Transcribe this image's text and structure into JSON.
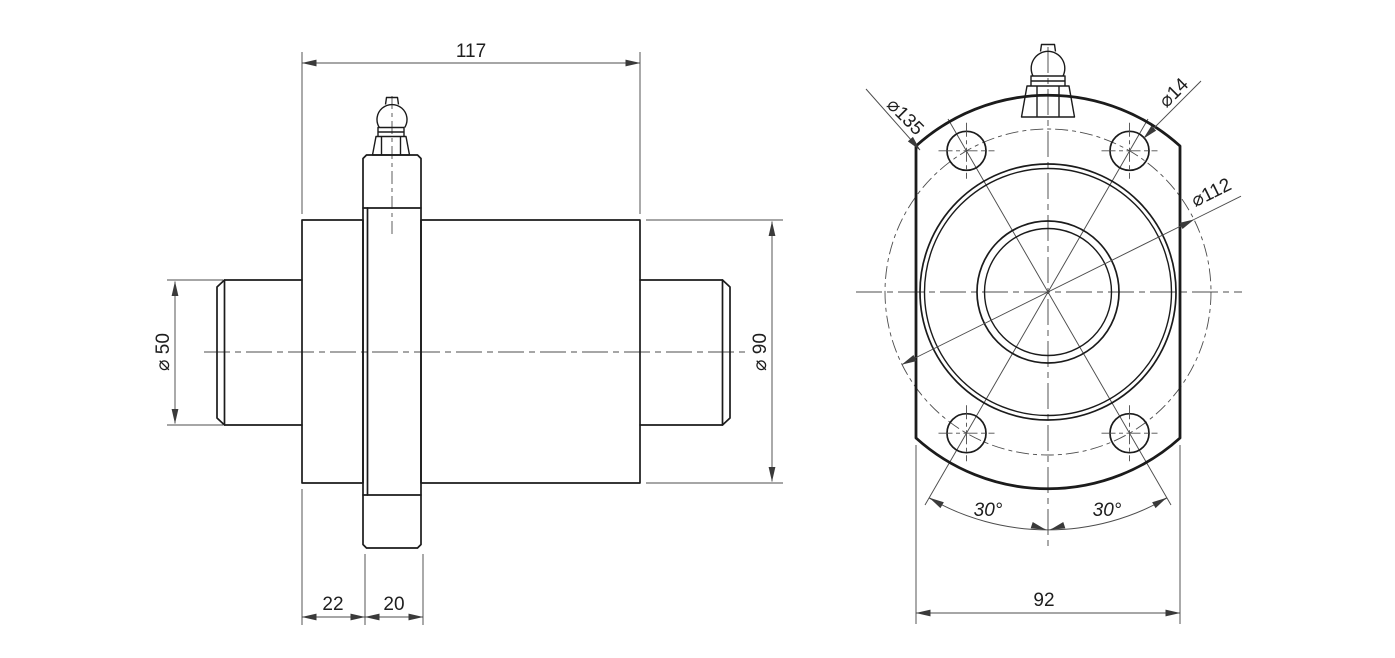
{
  "drawing": {
    "type": "technical-drawing",
    "part": "flanged bearing unit with grease fitting",
    "line_color": "#1b1b1b",
    "dim_color": "#4c4c4c",
    "dims": {
      "total_length": "117",
      "left_section_width": "22",
      "flange_thickness": "20",
      "shaft_diameter": "⌀ 50",
      "body_diameter": "⌀ 90",
      "flange_outer_diameter": "⌀135",
      "bolt_hole_diameter": "⌀14",
      "bolt_circle_diameter": "⌀112",
      "hole_angle_left": "30°",
      "hole_angle_right": "30°",
      "flange_width_across_flats": "92"
    }
  }
}
